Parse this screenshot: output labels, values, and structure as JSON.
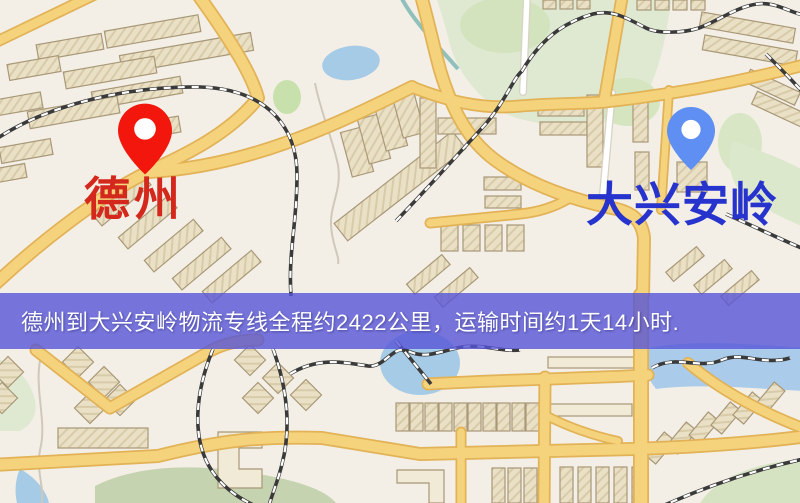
{
  "map": {
    "origin": {
      "label": "德州",
      "label_color": "#d4281c",
      "marker_color": "#f2160c",
      "marker_icon": "red-location-pin"
    },
    "destination": {
      "label": "大兴安岭",
      "label_color": "#2733cd",
      "marker_color": "#5f8ff2",
      "marker_icon": "blue-location-pin"
    },
    "banner": {
      "text": "德州到大兴安岭物流专线全程约2422公里，运输时间约1天14小时.",
      "background_color": "#5655d7",
      "text_color": "#ffffff",
      "distance_km": "2422",
      "transport_time": "1天14小时"
    },
    "palette": {
      "map_background": "#f4efe6",
      "road_yellow": "#f5d37c",
      "road_casing": "#e2b257",
      "building_fill": "#e9e0c6",
      "park_green": "#dfe9d2",
      "water_blue": "#a6cbe7",
      "railway_dark": "#3a3a3a"
    }
  }
}
